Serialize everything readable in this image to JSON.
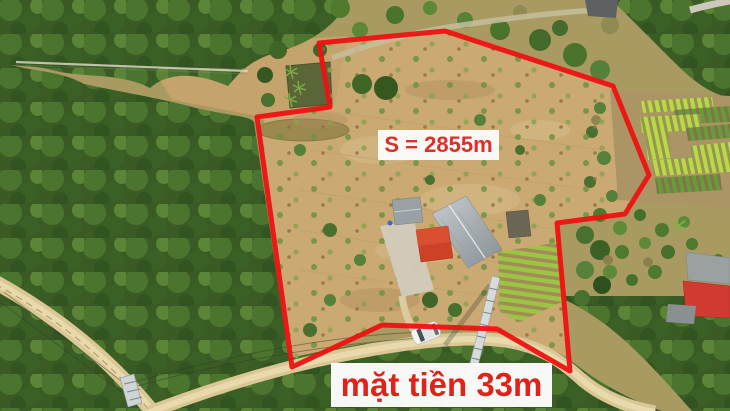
{
  "photo": {
    "type": "aerial-drone-photo-land-listing",
    "language": "vi"
  },
  "annotations": {
    "area_label": {
      "text": "S = 2855m",
      "text_color": "#d93129",
      "bg_color": "#fdfdfd"
    },
    "frontage_label": {
      "text": "mặt tiền 33m",
      "text_color": "#e0231a",
      "bg_color": "#ffffff"
    },
    "boundary": {
      "color": "#ee1111",
      "stroke_width": 5,
      "points": "319,43 445,31 613,86 649,175 625,214 557,223 563,290 570,371 497,329 382,325 292,367 257,117 330,107"
    }
  },
  "palette": {
    "forest_green": "#3a5c24",
    "plot_dirt": "#cba973",
    "road": "#dbc795",
    "red_roof": "#cd4127",
    "gray_roof": "#9aa1a5"
  }
}
